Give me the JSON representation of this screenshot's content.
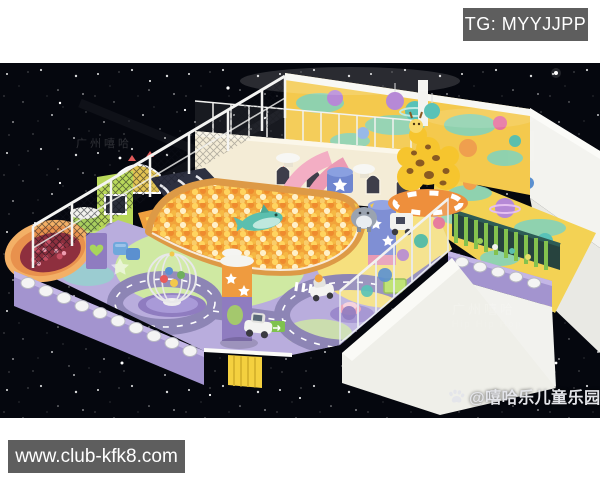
{
  "overlays": {
    "telegram_badge": {
      "label": "TG: MYYJJPP",
      "bg": "#5e5e5e",
      "text_color": "#ffffff"
    },
    "website_badge": {
      "label": "www.club-kfk8.com",
      "bg": "#5e5e5e",
      "text_color": "#ffffff"
    },
    "brand_watermark": {
      "label": "@嘻哈乐儿童乐园",
      "icon": "paw-icon",
      "text_color": "#e4e5ea"
    },
    "faint_watermarks": {
      "line1": "广州嘻哈",
      "line2": "Hip Hip Hop"
    }
  },
  "scene": {
    "description": "Isometric 3D render of a space-themed indoor children's soft-play center on a black starfield",
    "palette": {
      "space_background": "#05070e",
      "star": "#ffffff",
      "structure_white": "#f3f3ef",
      "wall_yellow": "#f4c94d",
      "wall_teal": "#7ed3c0",
      "ball_pit_orange": "#f2a43a",
      "ball_pit_rim": "#dd9a46",
      "floor_lavender": "#b9addd",
      "floor_green": "#cfe9a2",
      "floor_yellow": "#f6e07e",
      "road_gray": "#8d85b5",
      "base_wall_purple": "#a394cf",
      "slide_navy": "#2d3040",
      "slide_pink": "#f3aec4",
      "pen_fence_green": "#84c24e",
      "giraffe_yellow": "#f6c52e",
      "castle_cream": "#f4ecd6",
      "badge_gray": "#5e5e5e"
    }
  }
}
